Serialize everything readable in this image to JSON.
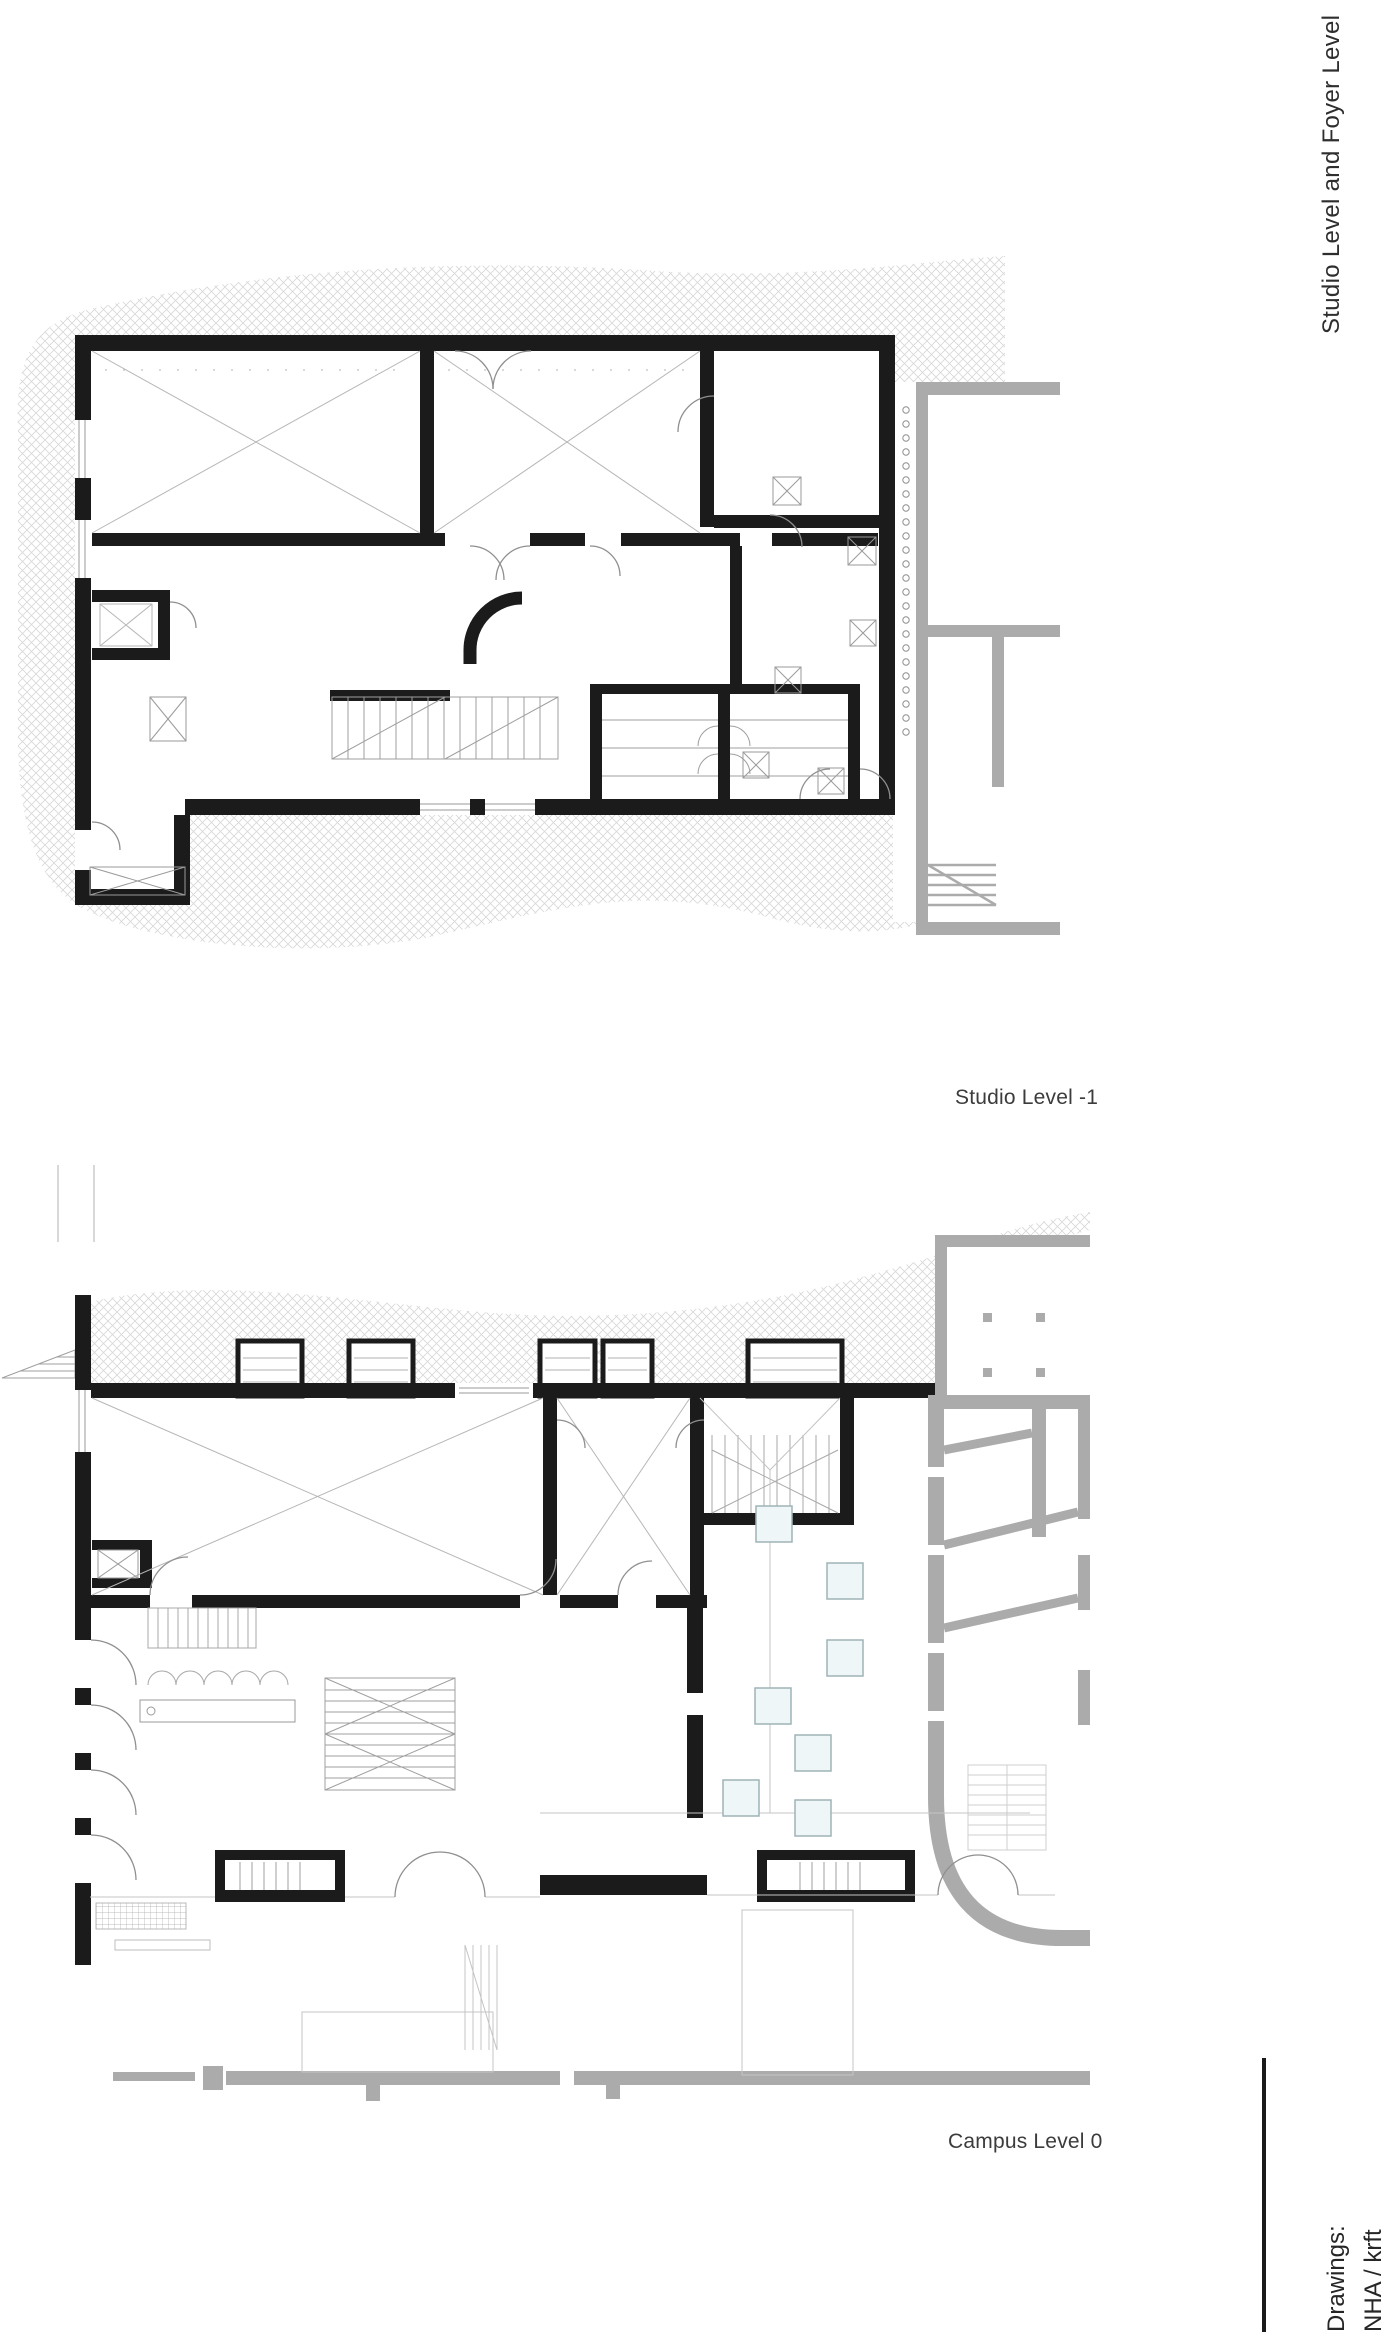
{
  "page": {
    "side_title": "Studio Level and Foyer Level",
    "background": "#ffffff"
  },
  "plans": [
    {
      "id": "studio-level-minus-1",
      "caption": "Studio Level -1"
    },
    {
      "id": "campus-level-0",
      "caption": "Campus Level 0"
    }
  ],
  "credits": {
    "label": "Drawings:",
    "value": "NHA / krft"
  },
  "colors": {
    "wall": "#1b1b1b",
    "context_building": "#ababab",
    "hatch_line": "#d7d7d7",
    "thin_line": "#b6b6b6",
    "medium_line": "#8f8f8f",
    "skylight_fill": "#eef6f7",
    "skylight_border": "#9fb4b6",
    "text": "#3c3c3c"
  }
}
